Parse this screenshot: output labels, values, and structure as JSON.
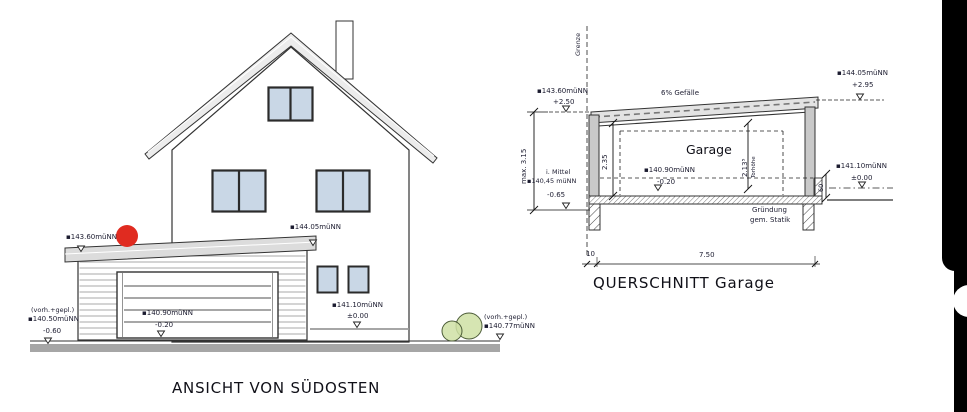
{
  "elevation": {
    "title": "ANSICHT VON SÜDOSTEN",
    "roof_left_level": "▪143.60müNN",
    "roof_right_level": "▪144.05müNN",
    "house_grade_level": "▪141.10müNN",
    "house_grade_rel": "±0.00",
    "left_note": "(vorh.+gepl.)",
    "left_level": "▪140.50müNN",
    "left_rel": "-0.60",
    "garage_floor_level": "▪140.90müNN",
    "garage_floor_rel": "-0.20",
    "right_note": "(vorh.+gepl.)",
    "right_level": "▪140.77müNN"
  },
  "section": {
    "title": "QUERSCHNITT  Garage",
    "boundary": "Grenze",
    "slope": "6% Gefälle",
    "roof_low_level": "▪143.60müNN",
    "roof_low_rel": "+2.50",
    "roof_high_level": "▪144.05müNN",
    "roof_high_rel": "+2.95",
    "room": "Garage",
    "clear_height": "2.35",
    "door_height": "2.13⁵",
    "door_height_label": "Torhöhe",
    "max_height": "max. 3.15",
    "avg_note": "i. Mittel",
    "avg_level": "▪140,45 müNN",
    "avg_rel": "-0.65",
    "floor_level": "▪140.90müNN",
    "floor_rel": "-0.20",
    "grade_level": "▪141.10müNN",
    "grade_rel": "±0.00",
    "curb_height": "60",
    "foundation_note_1": "Gründung",
    "foundation_note_2": "gem. Statik",
    "dim_boundary_offset": "10",
    "dim_width": "7.50"
  },
  "colors": {
    "window_blue": "#c9d7e6",
    "accent_red": "#e02b20",
    "shrub_green": "#cfe0a5",
    "roof_gray": "#e8e8e8",
    "ground_gray": "#a6a6a6",
    "ink": "#1c1c30"
  }
}
